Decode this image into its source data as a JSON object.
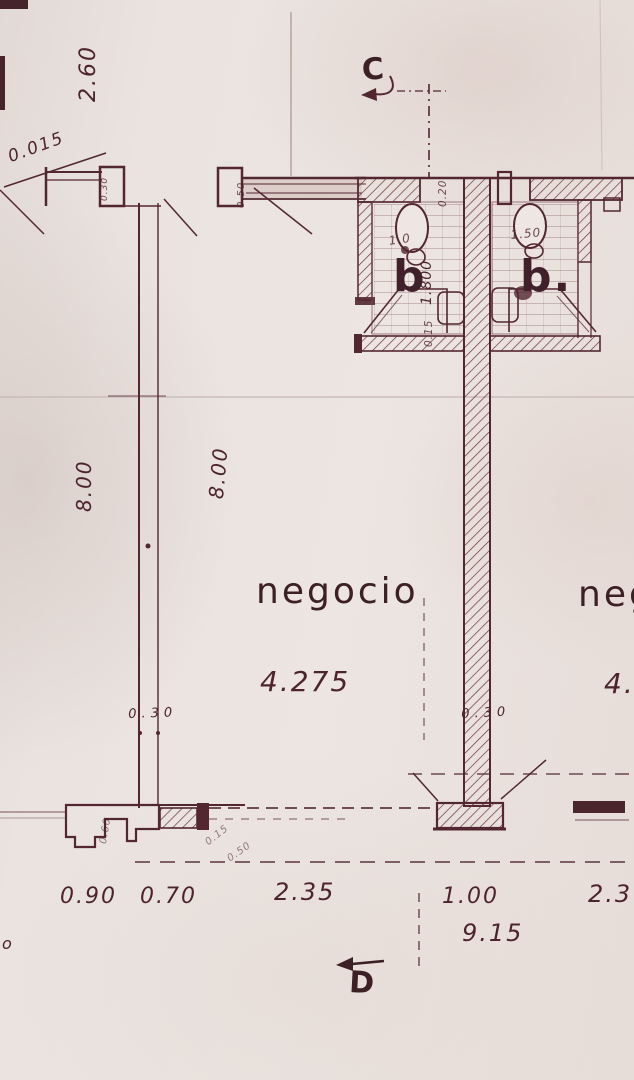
{
  "colors": {
    "paper": "#eae3df",
    "ink": "#532731",
    "ink_dark": "#46242b",
    "faint_line": "#ab9390"
  },
  "markers": {
    "section_top": "C",
    "section_bottom": "D"
  },
  "rooms": {
    "left_shop": {
      "name": "negocio",
      "width_dim": "4.275"
    },
    "right_shop": {
      "name": "neg",
      "width_dim": "4.2"
    },
    "bathroom_left": {
      "label": "b",
      "fixture_dim": "1.0"
    },
    "bathroom_right": {
      "label": "b.",
      "fixture_dim": "1.50"
    }
  },
  "dimensions": {
    "top_left_height": "2.60",
    "note_top_left": "0.015",
    "column_a": "0.30",
    "column_b": "0.50",
    "bath_wall_top": "0.20",
    "bath_depth": "1.800",
    "bath_wall_bottom": "0.15",
    "left_wall_height": "8.00",
    "right_wall_height": "8.00",
    "left_wall_thickness": "0.30",
    "center_wall_thickness": "0.30",
    "footing_a": "0.60",
    "footing_b": "0.15",
    "footing_c": "0.50",
    "bottom_row": [
      "0.90",
      "0.70",
      "2.35",
      "1.00",
      "2.3"
    ],
    "total_width": "9.15",
    "corner_mark": "o"
  }
}
